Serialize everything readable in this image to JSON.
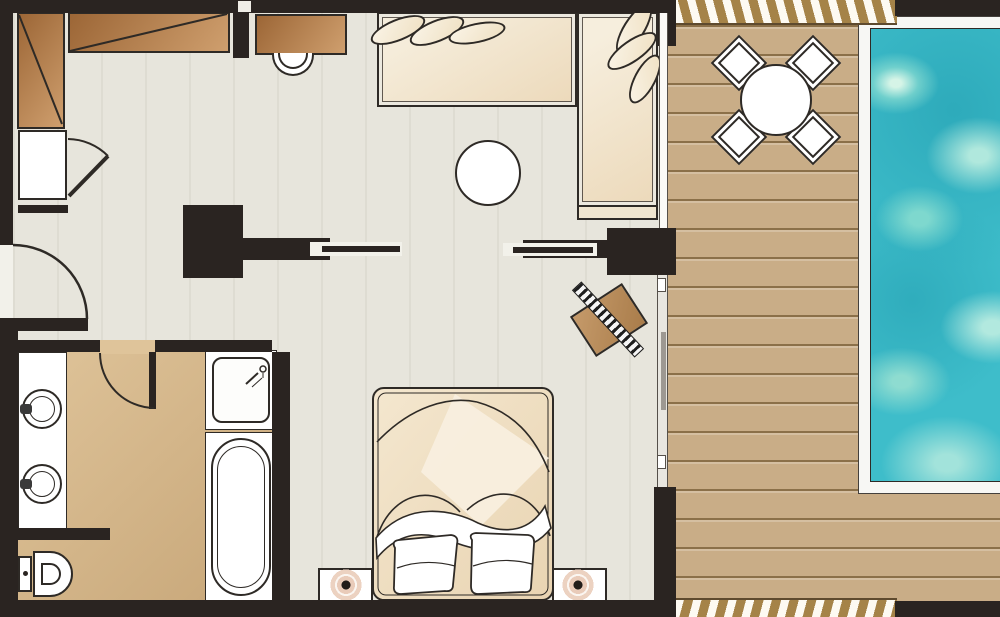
{
  "plan": {
    "kind": "hotel-suite-floor-plan-with-private-pool",
    "areas": {
      "living_room": {
        "furniture": [
          "wardrobe",
          "minibar-cabinet",
          "desk",
          "desk-chair",
          "corner-sofa",
          "sofa-cushions",
          "coffee-table",
          "tv-partition-walls"
        ]
      },
      "bedroom": {
        "furniture": [
          "double-bed",
          "bed-pillows",
          "nightstand-left",
          "nightstand-right",
          "table-lamp-left",
          "table-lamp-right",
          "luggage-rack"
        ]
      },
      "bathroom": {
        "fixtures": [
          "double-washbasin-vanity",
          "toilet",
          "shower",
          "bathtub"
        ],
        "doors": [
          "bathroom-door"
        ]
      },
      "entry": {
        "doors": [
          "entrance-door"
        ]
      },
      "terrace": {
        "furniture": [
          "outdoor-dining-table",
          "outdoor-chairs"
        ],
        "outdoor_chair_count": 4,
        "surface": "wood-deck"
      },
      "pool": {
        "type": "private-pool"
      }
    },
    "doors_and_glazing": [
      "entrance-door-swing",
      "bathroom-door-swing",
      "minibar-door-swing",
      "window-wall",
      "sliding-glass-door"
    ]
  },
  "palette": {
    "wall": "#2a2421",
    "outline": "#2e2a26",
    "floor": "#e7e5dc",
    "bath1": "#dfc49a",
    "bath2": "#c7a678",
    "wood1": "#9c6636",
    "wood2": "#cf9f6e",
    "cream1": "#f6eedd",
    "cream2": "#ecd9ba",
    "deck": "#c9ad87",
    "deckline": "#8b7049",
    "hatch": "#a58348",
    "glass": "#fbfaf7",
    "water": "#3ebdca",
    "waterlight": "#cdf2e2",
    "lampring": "#e9cbb9",
    "white": "#ffffff"
  }
}
